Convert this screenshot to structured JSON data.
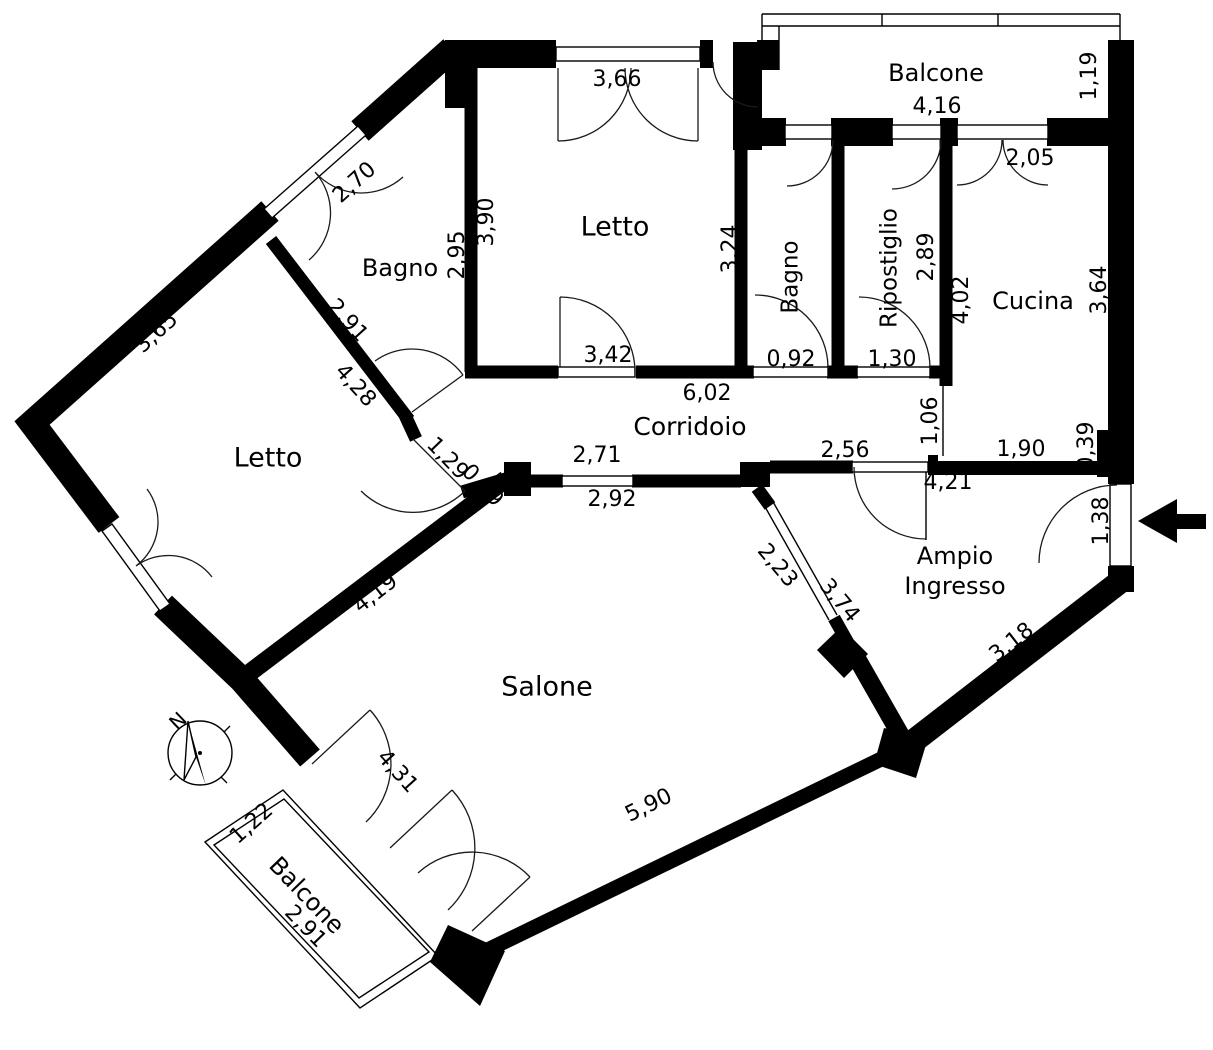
{
  "plan": {
    "type": "apartment-floor-plan",
    "colors": {
      "wall": "#000000",
      "background": "#ffffff",
      "line": "#1a1a1a"
    },
    "compass": {
      "label": "N",
      "x": 179,
      "y": 722,
      "rot": -44
    },
    "entry_arrow": {
      "direction": "left"
    },
    "rooms": [
      {
        "id": "letto-top",
        "label": "Letto",
        "x": 615,
        "y": 228,
        "rot": 0,
        "size": 27
      },
      {
        "id": "bagno-top-left",
        "label": "Bagno",
        "x": 400,
        "y": 269,
        "rot": 0,
        "size": 24
      },
      {
        "id": "letto-left",
        "label": "Letto",
        "x": 268,
        "y": 459,
        "rot": 0,
        "size": 27
      },
      {
        "id": "bagno-small",
        "label": "Bagno",
        "x": 791,
        "y": 277,
        "rot": -90,
        "size": 23
      },
      {
        "id": "ripostiglio",
        "label": "Ripostiglio",
        "x": 890,
        "y": 268,
        "rot": -90,
        "size": 23
      },
      {
        "id": "cucina",
        "label": "Cucina",
        "x": 1033,
        "y": 302,
        "rot": 0,
        "size": 24
      },
      {
        "id": "corridoio",
        "label": "Corridoio",
        "x": 690,
        "y": 428,
        "rot": 0,
        "size": 25
      },
      {
        "id": "ampio-ingresso-line1",
        "label": "Ampio",
        "x": 955,
        "y": 557,
        "rot": 0,
        "size": 24
      },
      {
        "id": "ampio-ingresso-line2",
        "label": "Ingresso",
        "x": 955,
        "y": 587,
        "rot": 0,
        "size": 24
      },
      {
        "id": "salone",
        "label": "Salone",
        "x": 547,
        "y": 688,
        "rot": 0,
        "size": 27
      },
      {
        "id": "balcone-top",
        "label": "Balcone",
        "x": 936,
        "y": 74,
        "rot": 0,
        "size": 24
      },
      {
        "id": "balcone-bottom",
        "label": "Balcone",
        "x": 306,
        "y": 896,
        "rot": 46,
        "size": 24
      }
    ],
    "dimensions": [
      {
        "label": "3,66",
        "x": 617,
        "y": 80,
        "rot": 0
      },
      {
        "label": "3,90",
        "x": 487,
        "y": 222,
        "rot": -90
      },
      {
        "label": "2,95",
        "x": 458,
        "y": 255,
        "rot": -90
      },
      {
        "label": "2,70",
        "x": 355,
        "y": 183,
        "rot": -42
      },
      {
        "label": "3,65",
        "x": 157,
        "y": 333,
        "rot": -42
      },
      {
        "label": "2,91",
        "x": 347,
        "y": 321,
        "rot": 48
      },
      {
        "label": "4,28",
        "x": 355,
        "y": 386,
        "rot": 48
      },
      {
        "label": "1,29",
        "x": 447,
        "y": 459,
        "rot": 46
      },
      {
        "label": "0,49",
        "x": 482,
        "y": 486,
        "rot": 46
      },
      {
        "label": "3,42",
        "x": 608,
        "y": 356,
        "rot": 0
      },
      {
        "label": "3,24",
        "x": 731,
        "y": 249,
        "rot": -90
      },
      {
        "label": "6,02",
        "x": 707,
        "y": 394,
        "rot": 0
      },
      {
        "label": "0,92",
        "x": 791,
        "y": 360,
        "rot": 0
      },
      {
        "label": "1,30",
        "x": 892,
        "y": 360,
        "rot": 0
      },
      {
        "label": "2,89",
        "x": 927,
        "y": 257,
        "rot": -90
      },
      {
        "label": "4,02",
        "x": 962,
        "y": 300,
        "rot": -90
      },
      {
        "label": "2,05",
        "x": 1030,
        "y": 159,
        "rot": 0
      },
      {
        "label": "3,64",
        "x": 1100,
        "y": 290,
        "rot": -90
      },
      {
        "label": "1,19",
        "x": 1090,
        "y": 76,
        "rot": -90
      },
      {
        "label": "4,16",
        "x": 937,
        "y": 107,
        "rot": 0
      },
      {
        "label": "1,06",
        "x": 931,
        "y": 421,
        "rot": -90
      },
      {
        "label": "1,90",
        "x": 1021,
        "y": 450,
        "rot": 0
      },
      {
        "label": "0,39",
        "x": 1087,
        "y": 446,
        "rot": -90
      },
      {
        "label": "2,56",
        "x": 845,
        "y": 451,
        "rot": 0
      },
      {
        "label": "4,21",
        "x": 948,
        "y": 483,
        "rot": 0
      },
      {
        "label": "2,71",
        "x": 597,
        "y": 456,
        "rot": 0
      },
      {
        "label": "2,92",
        "x": 612,
        "y": 500,
        "rot": 0
      },
      {
        "label": "1,38",
        "x": 1102,
        "y": 521,
        "rot": -90
      },
      {
        "label": "3,18",
        "x": 1012,
        "y": 643,
        "rot": -38
      },
      {
        "label": "2,23",
        "x": 777,
        "y": 566,
        "rot": 50
      },
      {
        "label": "3,74",
        "x": 839,
        "y": 601,
        "rot": 50
      },
      {
        "label": "4,19",
        "x": 376,
        "y": 594,
        "rot": -38
      },
      {
        "label": "4,31",
        "x": 397,
        "y": 772,
        "rot": 48
      },
      {
        "label": "5,90",
        "x": 649,
        "y": 806,
        "rot": -26
      },
      {
        "label": "1,22",
        "x": 252,
        "y": 824,
        "rot": -42
      },
      {
        "label": "2,91",
        "x": 305,
        "y": 927,
        "rot": 46
      }
    ]
  }
}
